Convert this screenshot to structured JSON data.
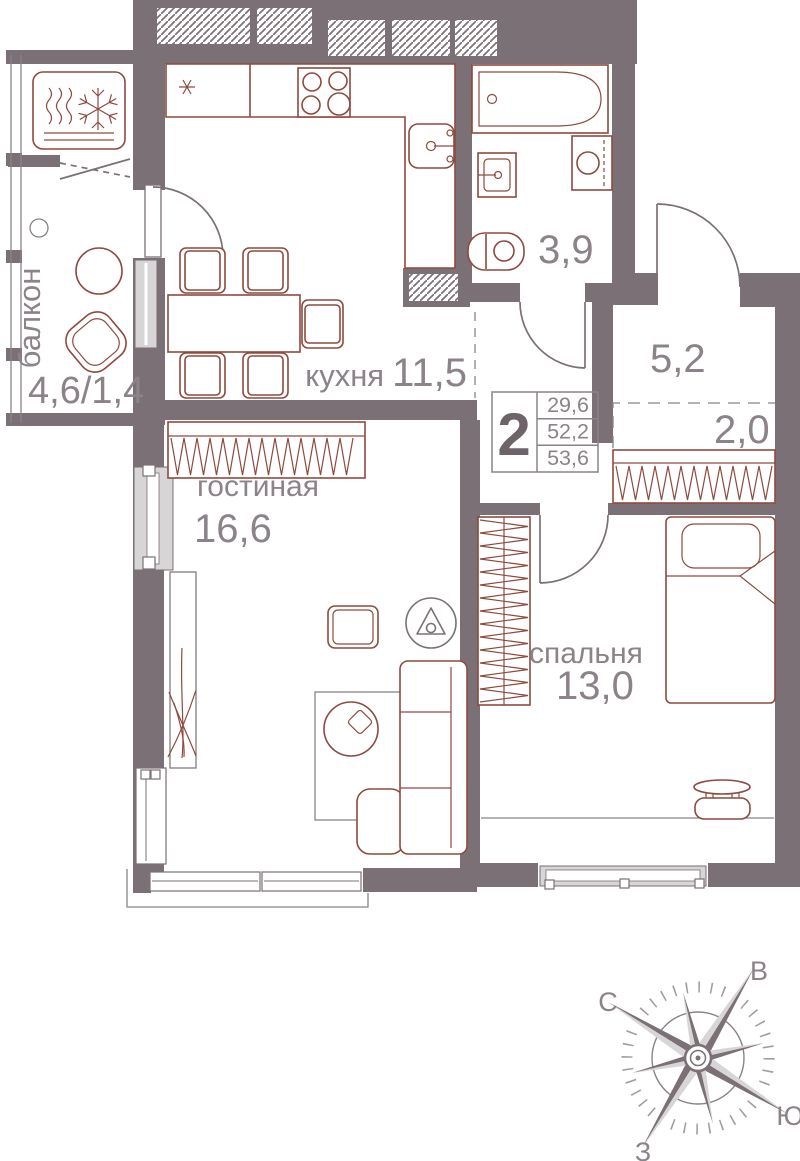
{
  "plan": {
    "type_badge": "2",
    "info_areas": [
      "29,6",
      "52,2",
      "53,6"
    ],
    "rooms": {
      "balcony": {
        "name": "балкон",
        "area": "4,6/1,4"
      },
      "kitchen": {
        "name": "кухня",
        "area": "11,5"
      },
      "living": {
        "name": "гостиная",
        "area": "16,6"
      },
      "bedroom": {
        "name": "спальня",
        "area": "13,0"
      },
      "bathroom": {
        "area": "3,9"
      },
      "hallway": {
        "area": "5,2"
      },
      "wardrobe_niche": {
        "area": "2,0"
      }
    }
  },
  "compass": {
    "north": "С",
    "east": "В",
    "south": "Ю",
    "west": "З"
  },
  "colors": {
    "wall": "#7a7076",
    "furniture_outline": "#8e4a3e",
    "glazing": "#d7d5d6",
    "label_text": "#8b8389",
    "badge_text": "#6d6369"
  }
}
